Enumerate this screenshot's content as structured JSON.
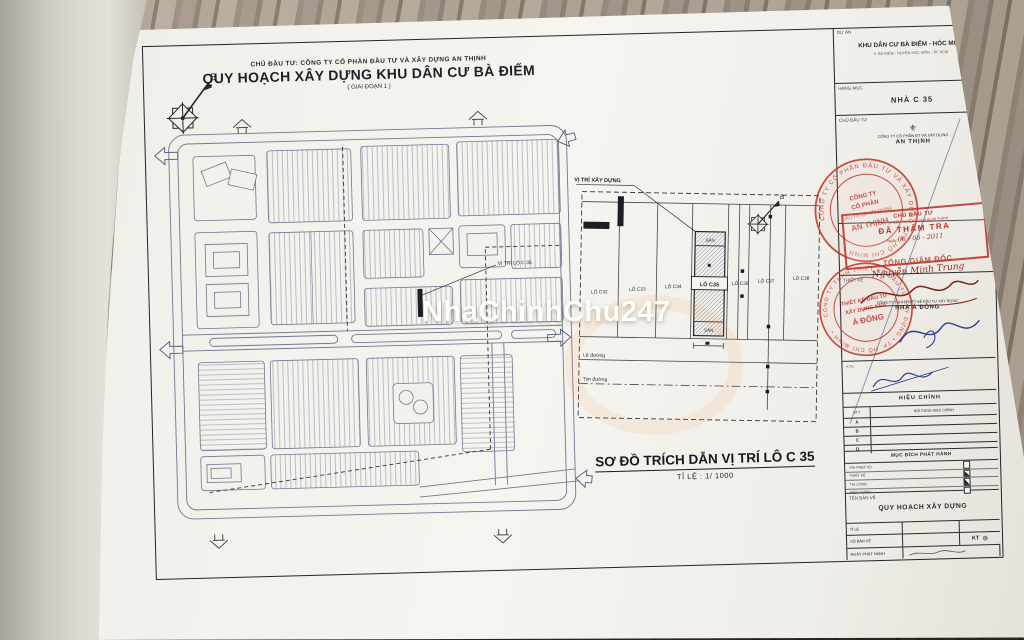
{
  "photo": {
    "watermark_text": "NhaChinhChu247"
  },
  "sheet_header": {
    "investor_line": "CHỦ ĐẦU TƯ: CÔNG TY CỔ PHẦN ĐẦU TƯ VÀ XÂY DỰNG AN THỊNH",
    "title": "QUY HOẠCH XÂY DỰNG KHU DÂN CƯ BÀ ĐIỂM",
    "phase": "( GIAI ĐOẠN 1 )",
    "compass_label": "B"
  },
  "site_plan": {
    "location_callout": "VỊ TRÍ LÔ C 35"
  },
  "detail_plan": {
    "callout": "VỊ TRÍ XÂY DỰNG",
    "compass_label": "B",
    "lots": [
      "LÔ C32",
      "LÔ C33",
      "LÔ C34",
      "LÔ C35",
      "LÔ C36",
      "LÔ C37",
      "LÔ C38"
    ],
    "yard_top": "SÂN",
    "yard_bottom": "SÂN",
    "road_edge_label": "Lề đường",
    "road_center_label": "Tim đường",
    "title": "SƠ ĐỒ TRÍCH DẪN VỊ TRÍ LÔ C 35",
    "scale": "TỈ LỆ : 1/ 1000"
  },
  "title_block": {
    "project_label": "DỰ ÁN",
    "project_name": "KHU DÂN CƯ BÀ ĐIỂM - HÓC MÔN",
    "project_address": "X. BÀ ĐIỂM - HUYỆN HÓC MÔN - TP. HCM",
    "item_label": "HẠNG MỤC",
    "item_value": "NHÀ C 35",
    "investor_label": "CHỦ ĐẦU TƯ",
    "investor_company": "CÔNG TY CỔ PHẦN ĐT VÀ XÂY DỰNG",
    "investor_name": "AN THỊNH",
    "director_title": "TỔNG GIÁM ĐỐC",
    "director_signature": "Nguyễn Minh Trung",
    "investor_stamp": {
      "ring": "CÔNG TY CỔ PHẦN ĐẦU TƯ VÀ XÂY DỰNG • TP. HỒ CHÍ MINH •",
      "l1": "CÔNG TY",
      "l2": "CỔ PHẦN",
      "l3": "ĐẦU TƯ VÀ XÂY DỰNG",
      "l4": "AN THỊNH"
    },
    "review_stamp": {
      "l1": "CHỦ ĐẦU TƯ",
      "l2": "CTY CP ĐẦU TƯ & XÂY DỰNG AN THỊNH",
      "l3": "ĐÃ THẨM TRA",
      "date_prefix": "Ngày",
      "date": "06 - 06 - 2011"
    },
    "designer_label": "THIẾT KẾ",
    "designer_company": "CÔNG TY TNHH THIẾT KẾ ĐẦU TƯ XÂY DỰNG",
    "designer_name": "NHÀ Á ĐÔNG",
    "designer_stamp": {
      "ring": "CÔNG TY TNHH THIẾT KẾ ĐẦU TƯ XÂY DỰNG • TP. HỒ CHÍ MINH •",
      "l1": "THIẾT KẾ ĐẦU TƯ",
      "l2": "XÂY DỰNG NHÀ",
      "l3": "Á ĐÔNG"
    },
    "architect_label": "KTS.",
    "revision": {
      "header": "HIỆU CHỈNH",
      "col_no": "STT",
      "col_content": "NỘI DUNG HIỆU CHỈNH",
      "rows": [
        "A",
        "B",
        "C",
        "D"
      ]
    },
    "purpose": {
      "header": "MỤC ĐÍCH PHÁT HÀNH",
      "items": [
        {
          "label": "XIN PHÉP XD",
          "checked": false
        },
        {
          "label": "THIẾT KẾ",
          "checked": true
        },
        {
          "label": "THI CÔNG",
          "checked": true
        },
        {
          "label": "HIỆU CHỈNH",
          "checked": false
        }
      ]
    },
    "drawing_label": "TÊN BẢN VẼ",
    "drawing_name": "QUY HOẠCH XÂY DỰNG",
    "footer": {
      "scale_label": "TỈ LỆ",
      "sheet_label": "SỐ BẢN VẼ",
      "kt": "KT",
      "issue_label": "NGÀY PHÁT HÀNH"
    }
  },
  "colors": {
    "stamp_red": "#c0392b",
    "pen_blue": "#2e3d8f",
    "ink": "#1c1c1c"
  }
}
